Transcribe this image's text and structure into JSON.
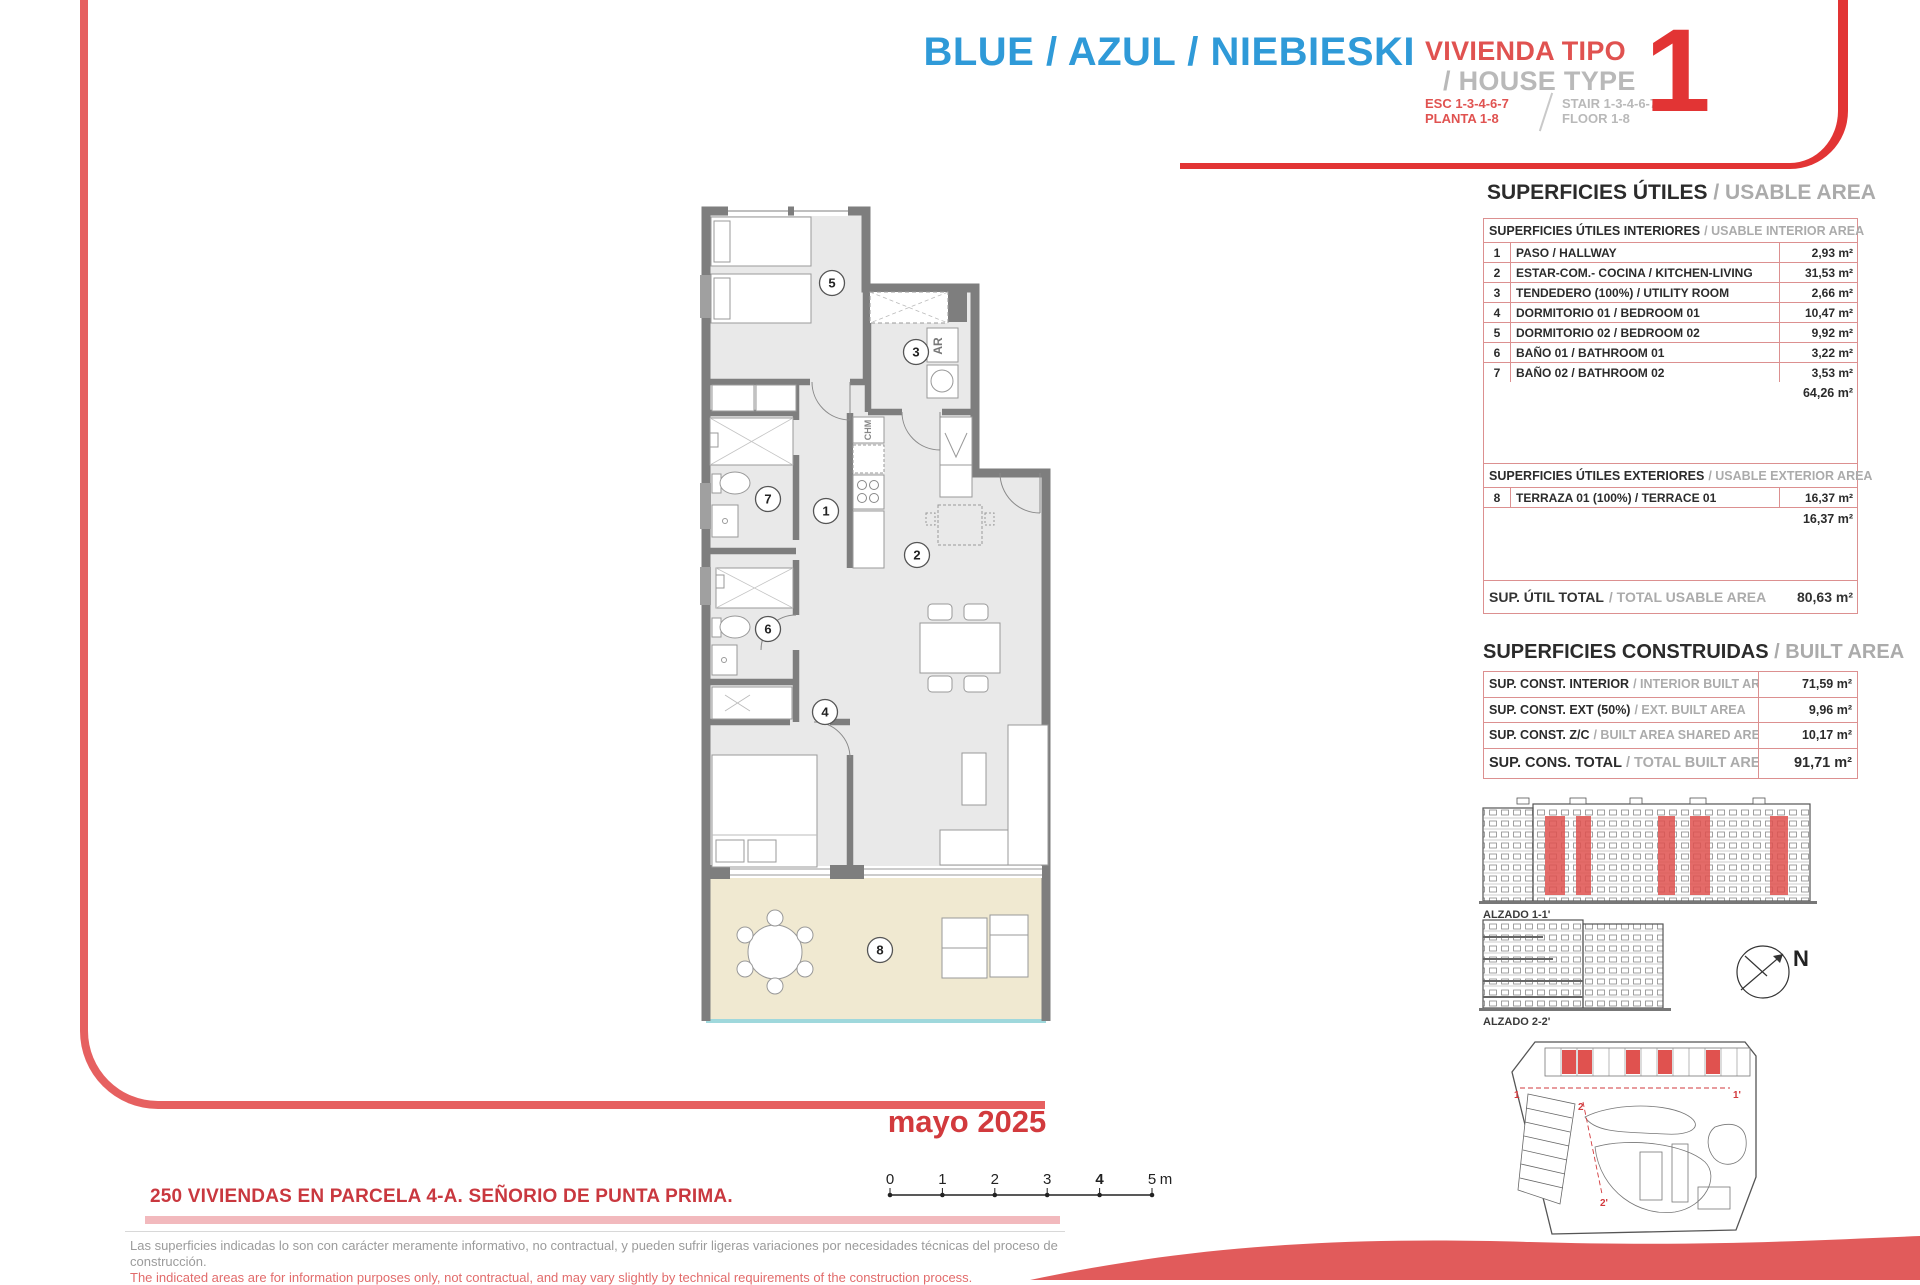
{
  "header": {
    "color_title": "BLUE / AZUL / NIEBIESKI",
    "type_label_es": "VIVIENDA TIPO",
    "type_label_en": "/ HOUSE TYPE",
    "type_number": "1",
    "esc_line1": "ESC 1-3-4-6-7",
    "esc_line2": "PLANTA 1-8",
    "stair_line1": "STAIR 1-3-4-6-7",
    "stair_line2": "FLOOR 1-8"
  },
  "usable": {
    "title_es": "SUPERFICIES ÚTILES",
    "title_en": "/ USABLE AREA",
    "interior_header_es": "SUPERFICIES ÚTILES INTERIORES",
    "interior_header_en": "/ USABLE INTERIOR AREA",
    "interior_rows": [
      {
        "num": "1",
        "label": "PASO / HALLWAY",
        "area": "2,93 m²"
      },
      {
        "num": "2",
        "label": "ESTAR-COM.- COCINA / KITCHEN-LIVING",
        "area": "31,53 m²"
      },
      {
        "num": "3",
        "label": "TENDEDERO (100%) / UTILITY ROOM",
        "area": "2,66 m²"
      },
      {
        "num": "4",
        "label": "DORMITORIO 01 / BEDROOM 01",
        "area": "10,47 m²"
      },
      {
        "num": "5",
        "label": "DORMITORIO 02 / BEDROOM 02",
        "area": "9,92 m²"
      },
      {
        "num": "6",
        "label": "BAÑO 01 / BATHROOM 01",
        "area": "3,22 m²"
      },
      {
        "num": "7",
        "label": "BAÑO 02 / BATHROOM 02",
        "area": "3,53 m²"
      }
    ],
    "interior_subtotal": "64,26 m²",
    "exterior_header_es": "SUPERFICIES ÚTILES EXTERIORES",
    "exterior_header_en": "/ USABLE EXTERIOR AREA",
    "exterior_rows": [
      {
        "num": "8",
        "label": "TERRAZA 01 (100%) / TERRACE 01",
        "area": "16,37 m²"
      }
    ],
    "exterior_subtotal": "16,37 m²",
    "total_label_es": "SUP. ÚTIL TOTAL",
    "total_label_en": "/ TOTAL USABLE AREA",
    "total_area": "80,63 m²"
  },
  "built": {
    "title_es": "SUPERFICIES CONSTRUIDAS",
    "title_en": "/ BUILT AREA",
    "rows": [
      {
        "es": "SUP. CONST. INTERIOR",
        "en": "/ INTERIOR BUILT AREA",
        "area": "71,59 m²"
      },
      {
        "es": "SUP. CONST. EXT (50%)",
        "en": "/ EXT. BUILT AREA",
        "area": "9,96 m²"
      },
      {
        "es": "SUP. CONST. Z/C",
        "en": "/ BUILT AREA SHARED AREAS",
        "area": "10,17 m²"
      },
      {
        "es": "SUP. CONS. TOTAL",
        "en": "/ TOTAL BUILT AREA",
        "area": "91,71 m²"
      }
    ]
  },
  "plan": {
    "rooms": [
      {
        "num": "1"
      },
      {
        "num": "2"
      },
      {
        "num": "3"
      },
      {
        "num": "4"
      },
      {
        "num": "5"
      },
      {
        "num": "6"
      },
      {
        "num": "7"
      },
      {
        "num": "8"
      }
    ],
    "labels": {
      "ar": "AR",
      "chm": "CHM"
    }
  },
  "elevations": {
    "alzado1_label": "ALZADO 1-1'",
    "alzado2_label": "ALZADO 2-2'",
    "north_label": "N",
    "section_marks": [
      "1",
      "1'",
      "2",
      "2'"
    ]
  },
  "footer": {
    "date": "mayo 2025",
    "project": "250 VIVIENDAS EN PARCELA 4-A. SEÑORIO DE PUNTA PRIMA.",
    "scale_ticks": [
      "0",
      "1",
      "2",
      "3",
      "4",
      "5"
    ],
    "scale_unit": "m",
    "disclaimer_es_line1": "Las superficies indicadas lo son con carácter meramente informativo, no contractual, y pueden sufrir ligeras variaciones por necesidades técnicas del proceso de",
    "disclaimer_es_line2": "construcción.",
    "disclaimer_en": "The indicated areas are for information purposes only, not contractual, and may vary slightly by technical requirements of the construction process."
  },
  "colors": {
    "blue": "#2f9ad8",
    "coral_red": "#e05250",
    "strong_red": "#e23434",
    "table_border": "#dc9090",
    "gray_text": "#ababab",
    "terrace_fill": "#f0e9d1",
    "room_fill": "#e9e9e9",
    "wall_gray": "#7e7e7e"
  }
}
